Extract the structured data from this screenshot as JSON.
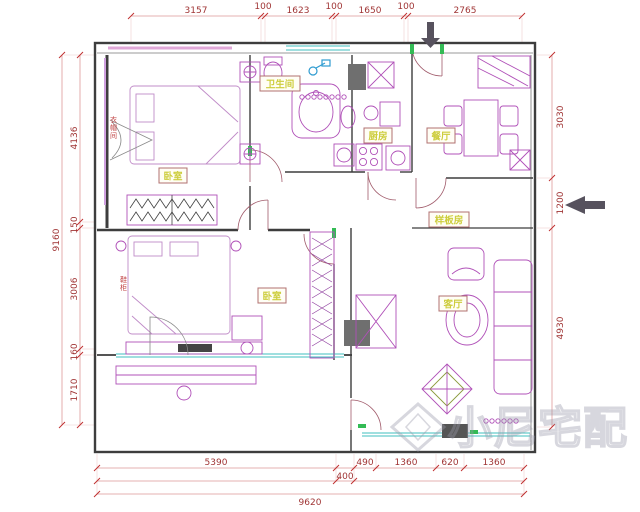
{
  "plan": {
    "rooms": [
      {
        "name": "卫生间"
      },
      {
        "name": "厨房"
      },
      {
        "name": "餐厅"
      },
      {
        "name": "卧室"
      },
      {
        "name": "样板房"
      },
      {
        "name": "卧室"
      },
      {
        "name": "客厅"
      }
    ],
    "mini_labels": [
      {
        "text": "衣帽间"
      },
      {
        "text": "鞋柜"
      }
    ],
    "dims": {
      "top": [
        "3157",
        "100",
        "1623",
        "100",
        "1650",
        "100",
        "2765"
      ],
      "left": [
        "4136",
        "150",
        "3006",
        "160",
        "1710"
      ],
      "left_total": "9160",
      "right": [
        "3030",
        "1200",
        "4930"
      ],
      "bottom": [
        "5390",
        "490",
        "1360",
        "620",
        "1360"
      ],
      "bottom_mid": "400",
      "bottom_total": "9620"
    },
    "watermark": "小尼宅配",
    "colors": {
      "dim_text": "#a03535",
      "furniture": "#b050b8",
      "window": "#3fbfbf",
      "accent_green": "#33bb55",
      "wall": "#3d3d3d",
      "label_text": "#cdcd3c"
    }
  }
}
